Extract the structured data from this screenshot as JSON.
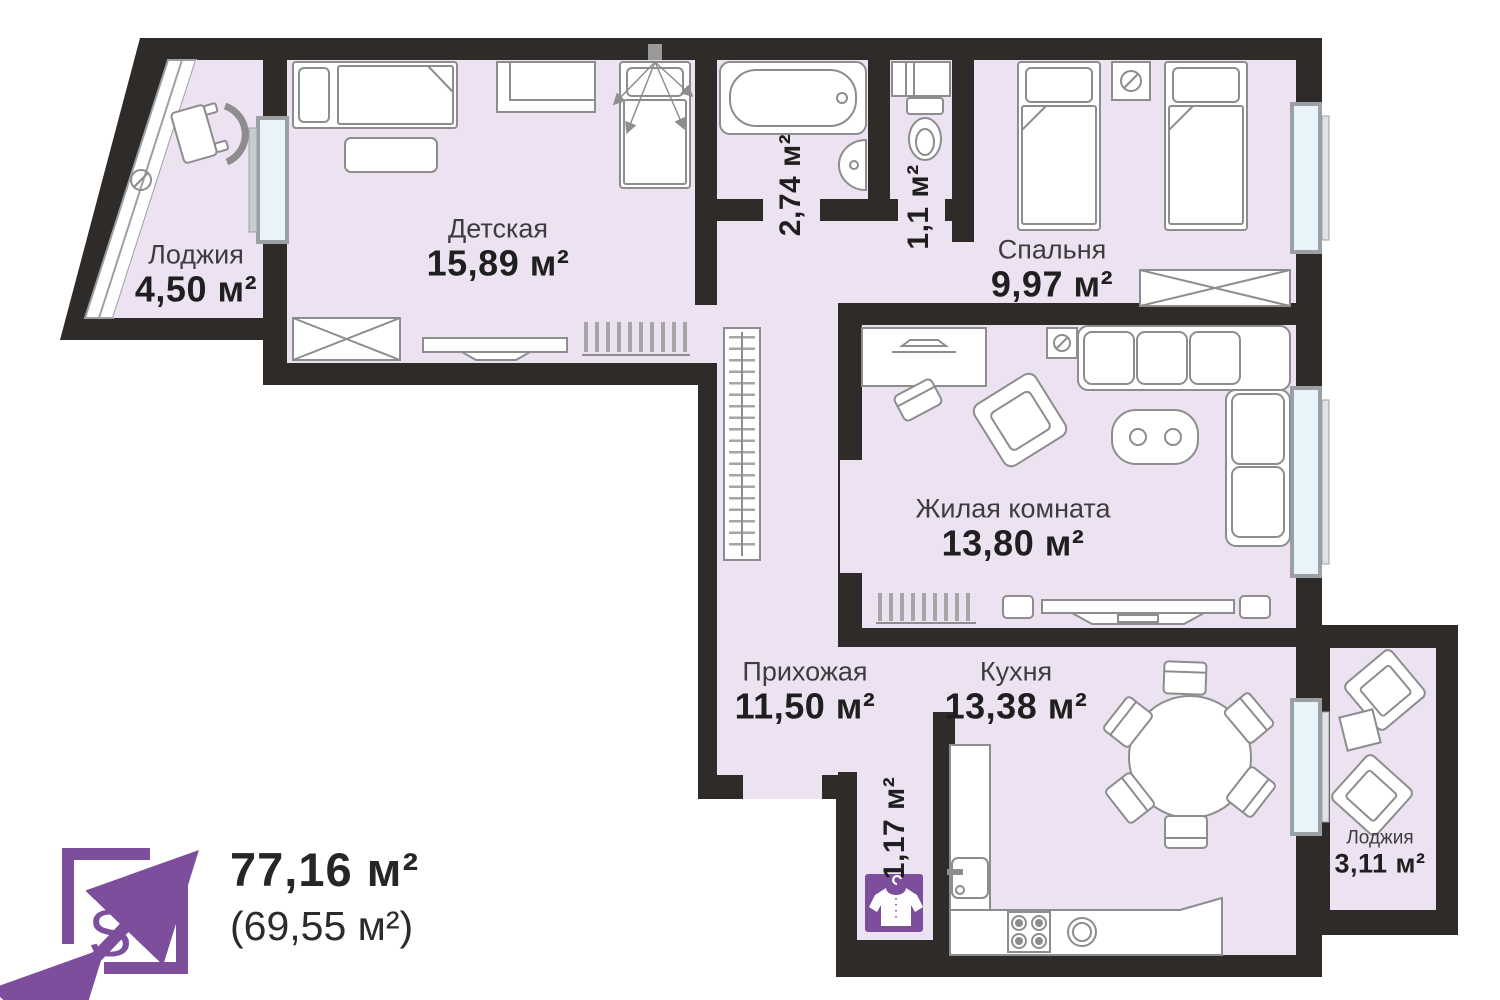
{
  "rooms": {
    "loggia_top": {
      "name": "Лоджия",
      "area": "4,50 м²"
    },
    "nursery": {
      "name": "Детская",
      "area": "15,89 м²"
    },
    "bathroom": {
      "area": "2,74 м²"
    },
    "wc": {
      "area": "1,1 м²"
    },
    "bedroom": {
      "name": "Спальня",
      "area": "9,97 м²"
    },
    "living_room": {
      "name": "Жилая комната",
      "area": "13,80 м²"
    },
    "hallway": {
      "name": "Прихожая",
      "area": "11,50 м²"
    },
    "kitchen": {
      "name": "Кухня",
      "area": "13,38 м²"
    },
    "closet": {
      "area": "1,17 м²"
    },
    "loggia_bottom": {
      "name": "Лоджия",
      "area": "3,11 м²"
    }
  },
  "summary": {
    "icon_letter": "S",
    "total_area": "77,16 м²",
    "living_area": "(69,55 м²)"
  },
  "colors": {
    "wall": "#2f2b29",
    "floor": "#ece2f1",
    "window_glass": "#e8f4fa",
    "window_frame": "#9aa0a4",
    "furniture_stroke": "#8d8d8d",
    "accent_purple": "#7c4e9b",
    "label_name": "#3d3d3d",
    "label_area": "#1f1f1f"
  },
  "icons": {
    "closet_icon": "shirt-on-hanger",
    "summary_icon": "expand-arrows-square",
    "lamp_symbol": "circle-slash"
  }
}
